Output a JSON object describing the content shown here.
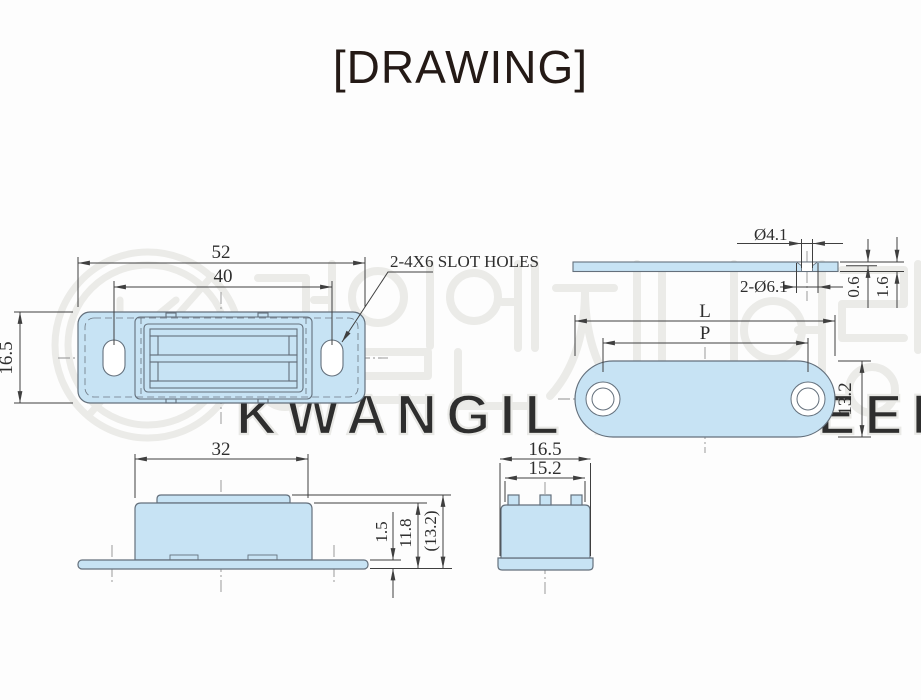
{
  "title": "[DRAWING]",
  "colors": {
    "part_fill": "#c7e3f4",
    "part_outline": "#64707c",
    "dimension_line": "#3f3f3f",
    "center_line": "#8f8f8f",
    "watermark": "#ebebe8",
    "title_text": "#241a16"
  },
  "views": {
    "plan": {
      "dim_overall_width": "52",
      "dim_hole_pitch": "40",
      "dim_height": "16.5",
      "slot_note": "2-4X6 SLOT HOLES"
    },
    "side": {
      "dim_body_width": "32",
      "dim_base_thickness": "1.5",
      "dim_body_height": "11.8",
      "dim_total_height": "(13.2)"
    },
    "end": {
      "dim_outer_width": "16.5",
      "dim_inner_width": "15.2"
    },
    "plate_side": {
      "dim_hole_dia": "Ø4.1",
      "dim_countersink": "2-Ø6.1",
      "dim_csk_depth": "0.6",
      "dim_thickness": "1.6"
    },
    "plate_plan": {
      "dim_length": "L",
      "dim_pitch": "P",
      "dim_width": "13.2"
    }
  },
  "watermark": {
    "logo_letter": "K",
    "korean_name": "광일엔지니어링",
    "english_name": "KWANGIL ENGINEERING"
  }
}
